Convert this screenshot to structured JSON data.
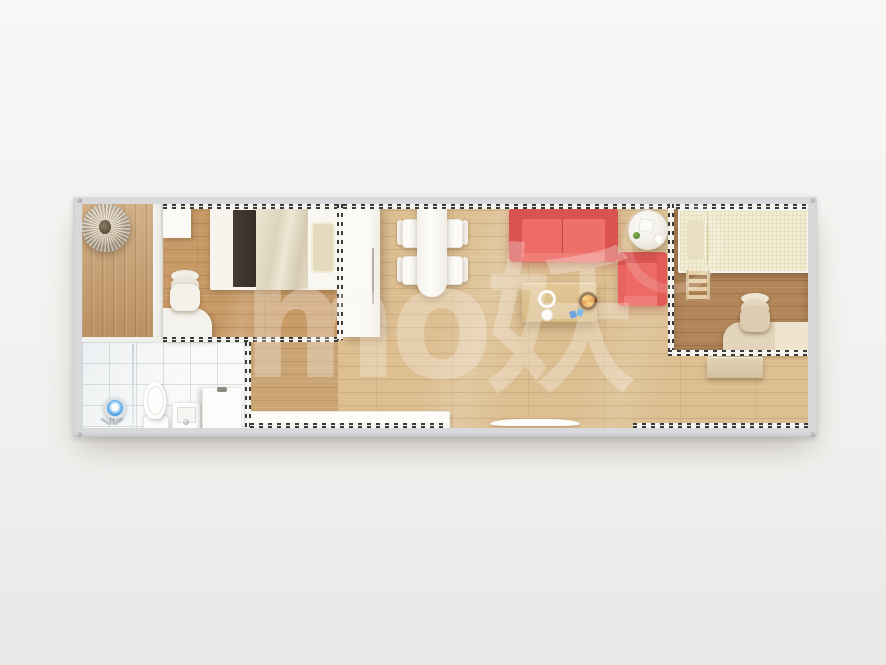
{
  "scene": {
    "title": "Top-down 3D render of a single-container tiny home floor plan",
    "watermark_text": "mo妖"
  },
  "colors": {
    "background": "#f3f2f0",
    "frame-gray": "#d8d9db",
    "accent-red": "#e96461",
    "accent-red-dark": "#d95351",
    "accent-red-light": "#f07d77",
    "wood-porch": "#c49a6a",
    "wood-bedroom": "#c89a66",
    "wood-living": "#dcbe90",
    "wood-dark": "#b3865a",
    "cream-bed": "#f2ecd2",
    "beige-furniture": "#ddcdb2",
    "wall-white": "#f6f4ef",
    "dash-dark": "#3a3a3a"
  },
  "rooms": {
    "porch": {
      "furniture": [
        "pendant-ornament"
      ]
    },
    "bedroom": {
      "furniture": [
        "small-wardrobe",
        "double-bed",
        "dark-bed-runner",
        "blanket",
        "pillow",
        "desk",
        "office-chair"
      ]
    },
    "bathroom": {
      "furniture": [
        "shower-fixture",
        "glass-divider",
        "toilet",
        "sink",
        "washing-machine"
      ]
    },
    "corridor": {
      "furniture": []
    },
    "living_dining": {
      "furniture": [
        "tall-cabinet",
        "dining-table",
        "dining-chair x4",
        "red-sofa",
        "round-side-table",
        "red-armchair",
        "wooden-coffee-table",
        "plate",
        "cup",
        "fruit-bowl",
        "toy",
        "low-counter",
        "entrance-mat"
      ]
    },
    "kids_bedroom": {
      "furniture": [
        "single-bed",
        "pillow",
        "ladder",
        "office-chair",
        "desk",
        "cabinet"
      ]
    }
  }
}
